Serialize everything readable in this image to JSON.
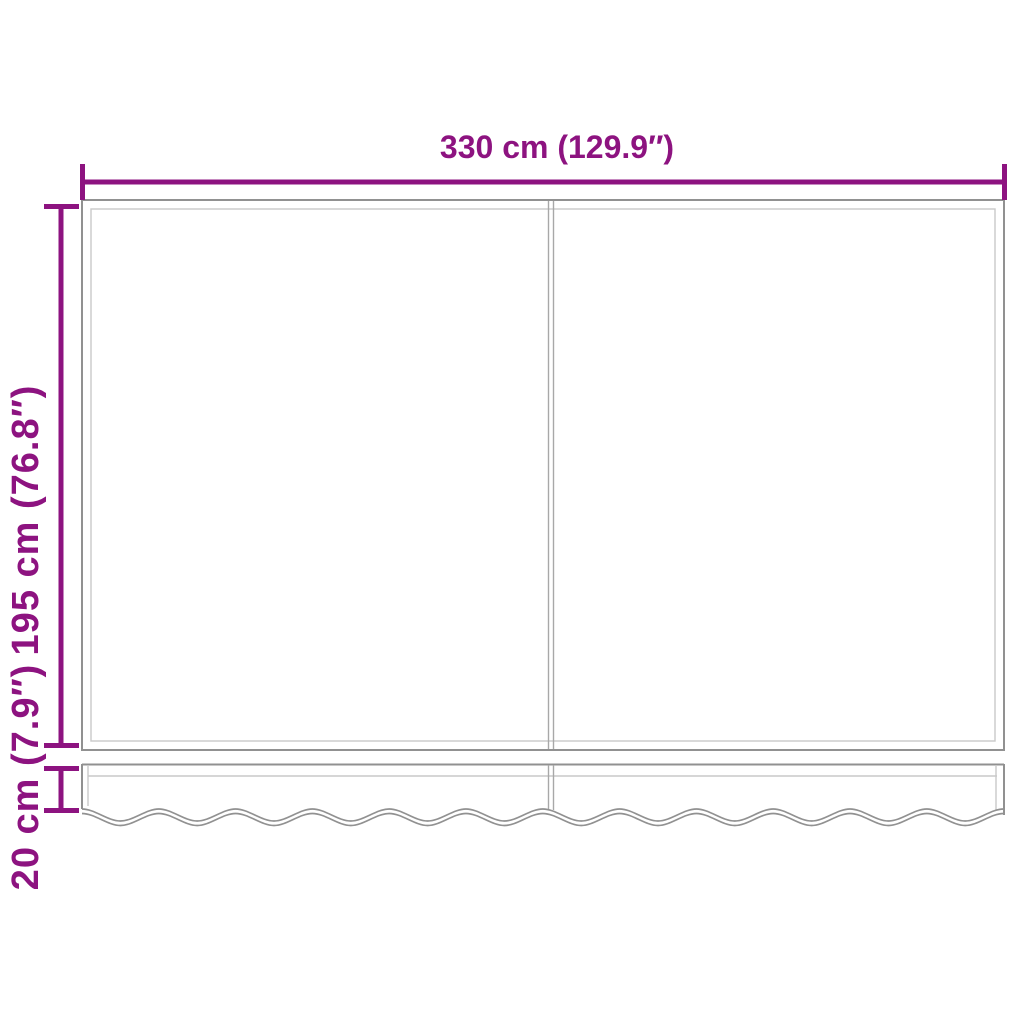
{
  "diagram": {
    "type": "product-dimension-diagram",
    "subject": "awning-replacement-fabric-with-valance",
    "labels": {
      "width": "330 cm (129.9″)",
      "height": "195 cm (76.8″)",
      "valance_height": "20 cm (7.9″)"
    },
    "colors": {
      "dimension": "#8D1380",
      "outline": "#919191",
      "outline_light": "#C9C9C9",
      "divider": "#A8A8A8",
      "background": "#FFFFFF"
    }
  }
}
